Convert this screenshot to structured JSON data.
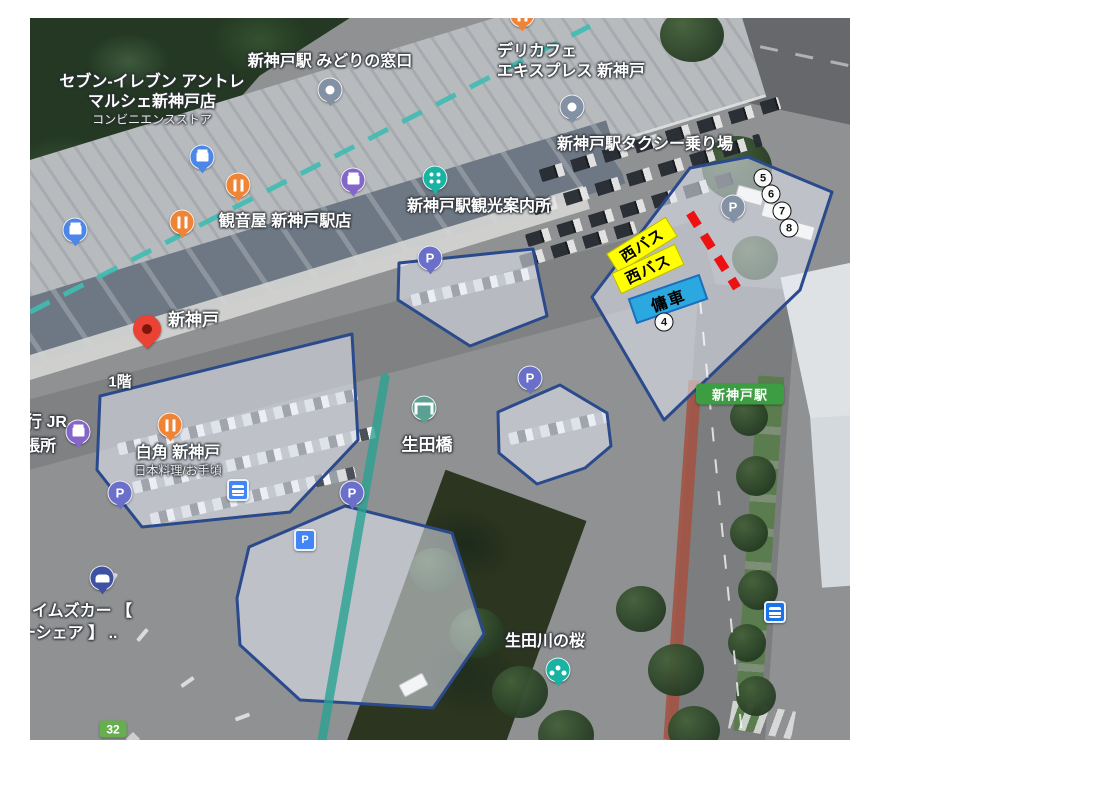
{
  "colors": {
    "hl-fill": "rgba(230,234,244,0.55)",
    "hl-border": "#2b4a8c",
    "bus-bg": "#ffff00",
    "hire-bg": "#2ba8e0",
    "dash-red": "#ee1111",
    "rail-teal": "#3fbdb2",
    "line-teal": "#2aa293",
    "badge-green": "#3c9d42",
    "route-green": "#67ae4e"
  },
  "labels": {
    "seven1": "セブン-イレブン アントレ",
    "seven2": "マルシェ新神戸店",
    "seven_sub": "コンビニエンスストア",
    "midori": "新神戸駅 みどりの窓口",
    "deli1": "デリカフェ",
    "deli2": "エキスプレス 新神戸",
    "taxi": "新神戸駅タクシー乗り場",
    "kannonya": "観音屋 新神戸駅店",
    "kanko": "新神戸駅観光案内所",
    "station_pin": "新神戸",
    "floor": "1階",
    "rest1": "白角 新神戸",
    "rest1_sub": "日本料理/お手頃",
    "jr1": "行 JR",
    "jr2": "張所",
    "ikutabashi": "生田橋",
    "times1": "イムズカー 【",
    "times2": "ーシェア 】 ..",
    "sakura": "生田川の桜",
    "station_badge": "新神戸駅",
    "route": "32"
  },
  "annotations": {
    "bus1": "西バス",
    "bus2": "西バス",
    "hire": "傭車",
    "num4": "4",
    "num5": "5",
    "num6": "6",
    "num7": "7",
    "num8": "8"
  },
  "icons": {
    "parking_glyph": "P"
  }
}
